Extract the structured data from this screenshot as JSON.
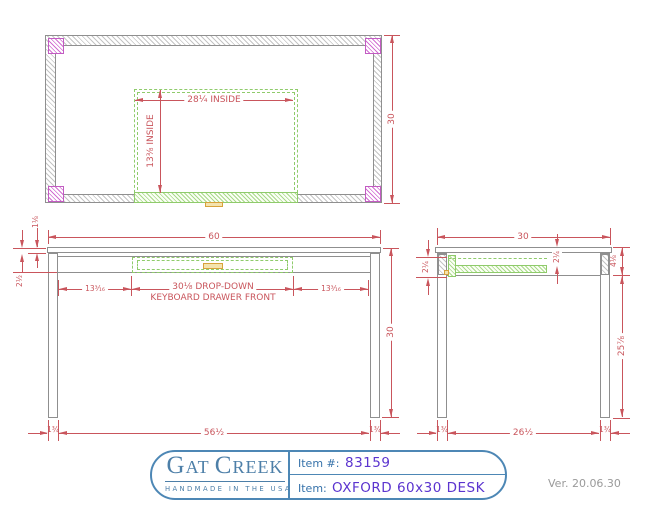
{
  "top_view": {
    "inside_width": "28¼ INSIDE",
    "inside_depth": "13⅜ INSIDE",
    "overall_depth": "30"
  },
  "front_view": {
    "overall_width": "60",
    "top_thickness": "1⅛",
    "apron_height": "2½",
    "left_offset": "13³⁄₁₆",
    "right_offset": "13³⁄₁₆",
    "drawer_label_line1": "30⅛ DROP-DOWN",
    "drawer_label_line2": "KEYBOARD DRAWER FRONT",
    "overall_height": "30",
    "between_legs": "56½",
    "leg_width_left": "1¾",
    "leg_width_right": "1¾"
  },
  "side_view": {
    "overall_depth": "30",
    "drawer_front_height": "2¼",
    "drawer_clearance": "2¼",
    "apron_drop": "4⅛",
    "floor_clearance": "25⅞",
    "between_legs": "26½",
    "leg_width_front": "1¾",
    "leg_width_back": "1¾"
  },
  "title_block": {
    "brand_g": "G",
    "brand_at": "AT ",
    "brand_c": "C",
    "brand_reek": "REEK",
    "tagline": "HANDMADE IN THE USA",
    "item_no_label": "Item #:",
    "item_no": "83159",
    "item_label": "Item:",
    "item_name": "OXFORD 60x30 DESK"
  },
  "version": "Ver. 20.06.30",
  "colors": {
    "dimension": "#c9555c",
    "outline": "#8f8f8f",
    "leg_section": "#c25cc2",
    "drawer": "#8fcb6b",
    "handle": "#d8a23a",
    "title_border": "#4d87b5",
    "item_value": "#5b34cf"
  }
}
